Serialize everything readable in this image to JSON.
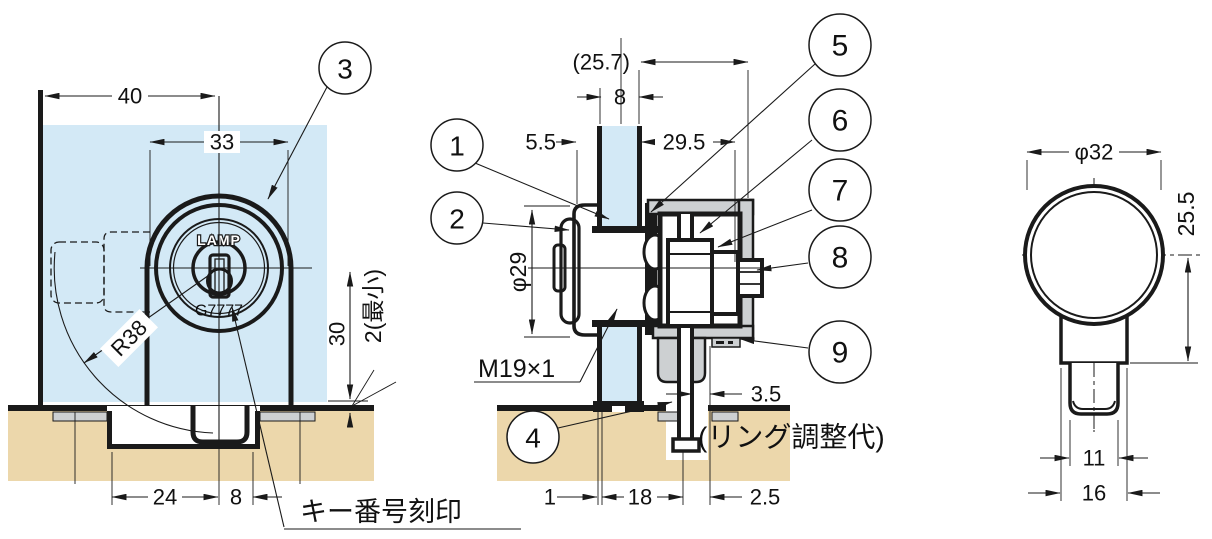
{
  "drawing_title": "glass-door-cylinder-lock-dimension-drawing",
  "colors": {
    "glass": "#d3e9f6",
    "wood": "#ecd7ab",
    "metal": "#cdd0d2",
    "line": "#1a1a1a"
  },
  "front_view": {
    "callout_3": "3",
    "dim_width_total": "40",
    "dim_width_body": "33",
    "dim_swing_radius": "R38",
    "dim_center_height": "30",
    "dim_min_clearance": "2(最小)",
    "dim_offset_24": "24",
    "dim_offset_8": "8",
    "brand": "LAMP",
    "key_number": "G7777",
    "key_stamp_note": "キー番号刻印"
  },
  "section_view": {
    "callout_1": "1",
    "callout_2": "2",
    "callout_4": "4",
    "callout_5": "5",
    "callout_6": "6",
    "callout_7": "7",
    "callout_8": "8",
    "callout_9": "9",
    "dim_ref_depth": "(25.7)",
    "dim_glass_thickness": "8",
    "dim_front_protrusion": "5.5",
    "dim_rear_depth": "29.5",
    "dim_cylinder_dia": "φ29",
    "thread_spec": "M19×1",
    "dim_ring_gap": "3.5",
    "ring_note": "(リング調整代)",
    "dim_edge_1": "1",
    "dim_center_18": "18",
    "dim_gap_2_5": "2.5"
  },
  "side_view": {
    "dim_knob_dia": "φ32",
    "dim_height": "25.5",
    "dim_tip_width": "11",
    "dim_neck_width": "16"
  }
}
